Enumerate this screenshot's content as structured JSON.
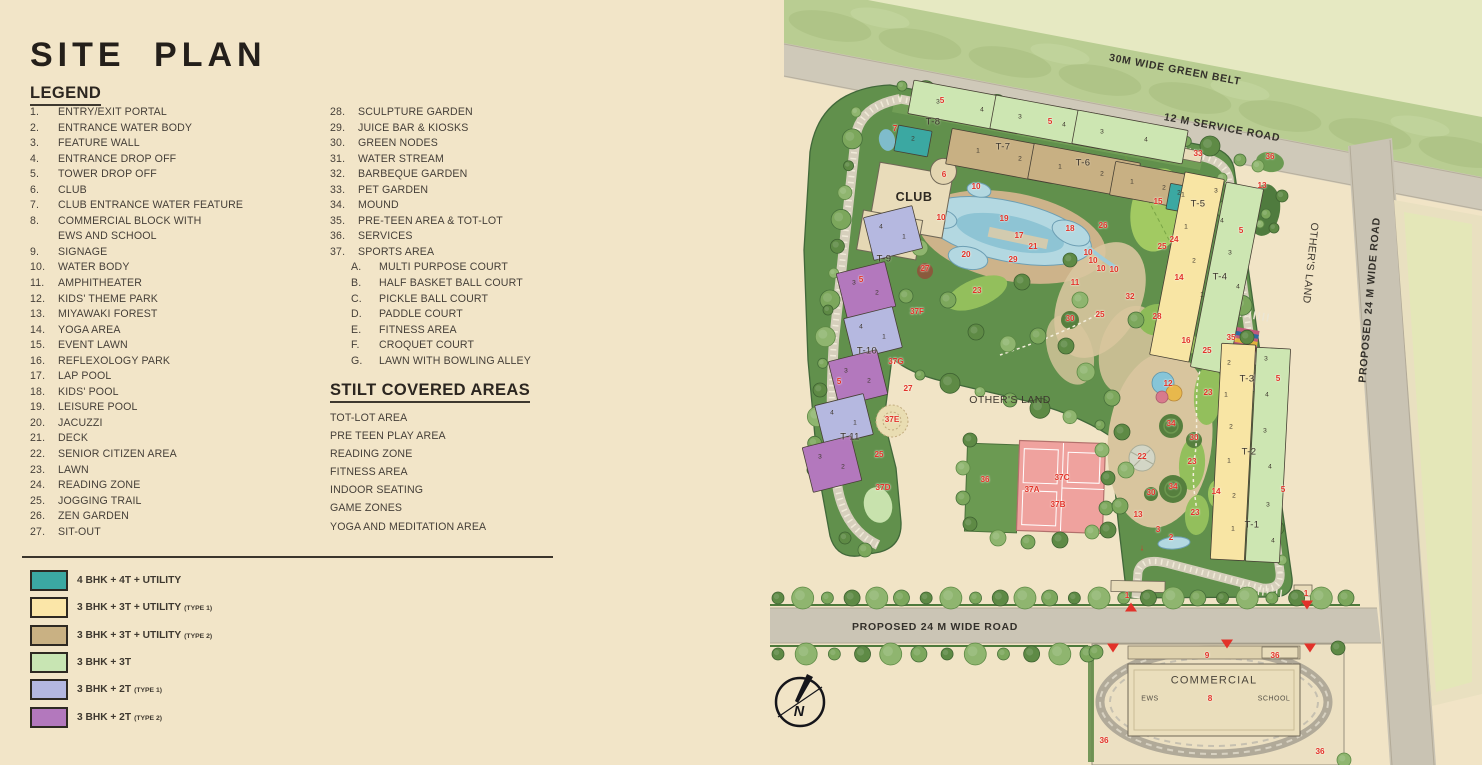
{
  "page": {
    "title": "SITE PLAN"
  },
  "legend": {
    "heading": "LEGEND",
    "col1": [
      {
        "n": "1.",
        "t": "ENTRY/EXIT PORTAL"
      },
      {
        "n": "2.",
        "t": "ENTRANCE WATER BODY"
      },
      {
        "n": "3.",
        "t": "FEATURE WALL"
      },
      {
        "n": "4.",
        "t": "ENTRANCE DROP OFF"
      },
      {
        "n": "5.",
        "t": "TOWER DROP OFF"
      },
      {
        "n": "6.",
        "t": "CLUB"
      },
      {
        "n": "7.",
        "t": "CLUB ENTRANCE WATER FEATURE"
      },
      {
        "n": "8.",
        "t": "COMMERCIAL BLOCK WITH"
      },
      {
        "n": "",
        "t": "EWS AND SCHOOL"
      },
      {
        "n": "9.",
        "t": "SIGNAGE"
      },
      {
        "n": "10.",
        "t": "WATER BODY"
      },
      {
        "n": "11.",
        "t": "AMPHITHEATER"
      },
      {
        "n": "12.",
        "t": "KIDS' THEME PARK"
      },
      {
        "n": "13.",
        "t": "MIYAWAKI FOREST"
      },
      {
        "n": "14.",
        "t": "YOGA AREA"
      },
      {
        "n": "15.",
        "t": "EVENT LAWN"
      },
      {
        "n": "16.",
        "t": "REFLEXOLOGY PARK"
      },
      {
        "n": "17.",
        "t": "LAP POOL"
      },
      {
        "n": "18.",
        "t": "KIDS' POOL"
      },
      {
        "n": "19.",
        "t": "LEISURE POOL"
      },
      {
        "n": "20.",
        "t": "JACUZZI"
      },
      {
        "n": "21.",
        "t": "DECK"
      },
      {
        "n": "22.",
        "t": "SENIOR CITIZEN AREA"
      },
      {
        "n": "23.",
        "t": "LAWN"
      },
      {
        "n": "24.",
        "t": "READING ZONE"
      },
      {
        "n": "25.",
        "t": "JOGGING TRAIL"
      },
      {
        "n": "26.",
        "t": "ZEN GARDEN"
      },
      {
        "n": "27.",
        "t": "SIT-OUT"
      }
    ],
    "col2": [
      {
        "n": "28.",
        "t": "SCULPTURE GARDEN"
      },
      {
        "n": "29.",
        "t": "JUICE BAR & KIOSKS"
      },
      {
        "n": "30.",
        "t": "GREEN NODES"
      },
      {
        "n": "31.",
        "t": "WATER STREAM"
      },
      {
        "n": "32.",
        "t": "BARBEQUE GARDEN"
      },
      {
        "n": "33.",
        "t": "PET GARDEN"
      },
      {
        "n": "34.",
        "t": "MOUND"
      },
      {
        "n": "35.",
        "t": "PRE-TEEN AREA & TOT-LOT"
      },
      {
        "n": "36.",
        "t": "SERVICES"
      },
      {
        "n": "37.",
        "t": "SPORTS AREA"
      }
    ],
    "col2_sub": [
      {
        "n": "A.",
        "t": "MULTI PURPOSE COURT"
      },
      {
        "n": "B.",
        "t": "HALF BASKET BALL COURT"
      },
      {
        "n": "C.",
        "t": "PICKLE BALL COURT"
      },
      {
        "n": "D.",
        "t": "PADDLE COURT"
      },
      {
        "n": "E.",
        "t": "FITNESS AREA"
      },
      {
        "n": "F.",
        "t": "CROQUET COURT"
      },
      {
        "n": "G.",
        "t": "LAWN WITH BOWLING ALLEY"
      }
    ]
  },
  "stilt": {
    "heading": "STILT COVERED AREAS",
    "items": [
      "TOT-LOT AREA",
      "PRE TEEN PLAY AREA",
      "READING ZONE",
      "FITNESS AREA",
      "INDOOR SEATING",
      "GAME ZONES",
      "YOGA AND MEDITATION AREA"
    ]
  },
  "unit_types": [
    {
      "color": "#3BA8A2",
      "label": "4 BHK + 4T + UTILITY",
      "sub": ""
    },
    {
      "color": "#FBE6A8",
      "label": "3 BHK + 3T + UTILITY",
      "sub": "(TYPE 1)"
    },
    {
      "color": "#C9B183",
      "label": "3 BHK + 3T + UTILITY",
      "sub": "(TYPE 2)"
    },
    {
      "color": "#C8E5B3",
      "label": "3 BHK + 3T",
      "sub": ""
    },
    {
      "color": "#B4B7E0",
      "label": "3 BHK + 2T",
      "sub": "(TYPE 1)"
    },
    {
      "color": "#B378BD",
      "label": "3 BHK + 2T",
      "sub": "(TYPE 2)"
    }
  ],
  "map": {
    "colors": {
      "teal": "#3BA8A2",
      "yellow": "#F8E5A4",
      "tan": "#C8B083",
      "green": "#CDE6B2",
      "lilac": "#B5B8E0",
      "purple": "#B378BD",
      "red": "#E2322A"
    },
    "labels": [
      {
        "t": "30M WIDE GREEN BELT",
        "x": 405,
        "y": 70,
        "k": "road",
        "r": 10.5
      },
      {
        "t": "12 M SERVICE ROAD",
        "x": 452,
        "y": 128,
        "k": "road",
        "r": 10.5
      },
      {
        "t": "PROPOSED 24 M WIDE ROAD",
        "x": 600,
        "y": 300,
        "k": "road",
        "r": -85
      },
      {
        "t": "PROPOSED 24 M WIDE ROAD",
        "x": 165,
        "y": 627,
        "k": "road"
      },
      {
        "t": "OTHER'S LAND",
        "x": 540,
        "y": 263,
        "k": "place",
        "r": 96
      },
      {
        "t": "OTHER'S LAND",
        "x": 240,
        "y": 400,
        "k": "place"
      },
      {
        "t": "CLUB",
        "x": 144,
        "y": 197,
        "k": "big"
      },
      {
        "t": "COMMERCIAL",
        "x": 444,
        "y": 681,
        "k": "big2"
      },
      {
        "t": "EWS",
        "x": 380,
        "y": 699,
        "k": "small"
      },
      {
        "t": "SCHOOL",
        "x": 504,
        "y": 699,
        "k": "small"
      },
      {
        "t": "N",
        "x": 29,
        "y": 712,
        "k": "compass"
      },
      {
        "t": "T-8",
        "x": 163,
        "y": 122,
        "k": "tower"
      },
      {
        "t": "T-7",
        "x": 233,
        "y": 147,
        "k": "tower"
      },
      {
        "t": "T-6",
        "x": 313,
        "y": 163,
        "k": "tower"
      },
      {
        "t": "T-9",
        "x": 114,
        "y": 259,
        "k": "tower"
      },
      {
        "t": "T-10",
        "x": 97,
        "y": 351,
        "k": "tower"
      },
      {
        "t": "T-11",
        "x": 80,
        "y": 437,
        "k": "tower"
      },
      {
        "t": "T-5",
        "x": 428,
        "y": 204,
        "k": "tower"
      },
      {
        "t": "T-4",
        "x": 450,
        "y": 277,
        "k": "tower"
      },
      {
        "t": "T-3",
        "x": 477,
        "y": 379,
        "k": "tower"
      },
      {
        "t": "T-2",
        "x": 479,
        "y": 452,
        "k": "tower"
      },
      {
        "t": "T-1",
        "x": 482,
        "y": 525,
        "k": "tower"
      },
      {
        "t": "5",
        "x": 172,
        "y": 101,
        "k": "red"
      },
      {
        "t": "7",
        "x": 125,
        "y": 129,
        "k": "red"
      },
      {
        "t": "5",
        "x": 280,
        "y": 122,
        "k": "red"
      },
      {
        "t": "6",
        "x": 174,
        "y": 175,
        "k": "red"
      },
      {
        "t": "10",
        "x": 206,
        "y": 187,
        "k": "red"
      },
      {
        "t": "10",
        "x": 171,
        "y": 218,
        "k": "red"
      },
      {
        "t": "19",
        "x": 234,
        "y": 219,
        "k": "red"
      },
      {
        "t": "18",
        "x": 300,
        "y": 229,
        "k": "red"
      },
      {
        "t": "26",
        "x": 333,
        "y": 226,
        "k": "red"
      },
      {
        "t": "17",
        "x": 249,
        "y": 236,
        "k": "red"
      },
      {
        "t": "21",
        "x": 263,
        "y": 247,
        "k": "red"
      },
      {
        "t": "20",
        "x": 196,
        "y": 255,
        "k": "red"
      },
      {
        "t": "29",
        "x": 243,
        "y": 260,
        "k": "red"
      },
      {
        "t": "27",
        "x": 155,
        "y": 269,
        "k": "red"
      },
      {
        "t": "23",
        "x": 207,
        "y": 291,
        "k": "red"
      },
      {
        "t": "11",
        "x": 305,
        "y": 283,
        "k": "red"
      },
      {
        "t": "10",
        "x": 318,
        "y": 253,
        "k": "red"
      },
      {
        "t": "10",
        "x": 323,
        "y": 261,
        "k": "red"
      },
      {
        "t": "10",
        "x": 331,
        "y": 269,
        "k": "red"
      },
      {
        "t": "10",
        "x": 344,
        "y": 270,
        "k": "red"
      },
      {
        "t": "37F",
        "x": 147,
        "y": 312,
        "k": "red"
      },
      {
        "t": "30",
        "x": 300,
        "y": 319,
        "k": "red"
      },
      {
        "t": "25",
        "x": 330,
        "y": 315,
        "k": "red"
      },
      {
        "t": "5",
        "x": 91,
        "y": 280,
        "k": "red"
      },
      {
        "t": "33",
        "x": 428,
        "y": 154,
        "k": "red"
      },
      {
        "t": "36",
        "x": 500,
        "y": 157,
        "k": "red"
      },
      {
        "t": "13",
        "x": 492,
        "y": 186,
        "k": "red"
      },
      {
        "t": "15",
        "x": 388,
        "y": 202,
        "k": "red"
      },
      {
        "t": "24",
        "x": 404,
        "y": 240,
        "k": "red"
      },
      {
        "t": "25",
        "x": 392,
        "y": 247,
        "k": "red"
      },
      {
        "t": "5",
        "x": 471,
        "y": 231,
        "k": "red"
      },
      {
        "t": "14",
        "x": 409,
        "y": 278,
        "k": "red"
      },
      {
        "t": "32",
        "x": 360,
        "y": 297,
        "k": "red"
      },
      {
        "t": "28",
        "x": 387,
        "y": 317,
        "k": "red"
      },
      {
        "t": "16",
        "x": 416,
        "y": 341,
        "k": "red"
      },
      {
        "t": "25",
        "x": 437,
        "y": 351,
        "k": "red"
      },
      {
        "t": "35",
        "x": 461,
        "y": 338,
        "k": "red"
      },
      {
        "t": "12",
        "x": 398,
        "y": 384,
        "k": "red"
      },
      {
        "t": "23",
        "x": 438,
        "y": 393,
        "k": "red"
      },
      {
        "t": "34",
        "x": 401,
        "y": 424,
        "k": "red"
      },
      {
        "t": "30",
        "x": 424,
        "y": 438,
        "k": "red"
      },
      {
        "t": "22",
        "x": 372,
        "y": 457,
        "k": "red"
      },
      {
        "t": "23",
        "x": 422,
        "y": 462,
        "k": "red"
      },
      {
        "t": "34",
        "x": 403,
        "y": 487,
        "k": "red"
      },
      {
        "t": "30",
        "x": 381,
        "y": 493,
        "k": "red"
      },
      {
        "t": "14",
        "x": 446,
        "y": 492,
        "k": "red"
      },
      {
        "t": "23",
        "x": 425,
        "y": 513,
        "k": "red"
      },
      {
        "t": "13",
        "x": 368,
        "y": 515,
        "k": "red"
      },
      {
        "t": "3",
        "x": 388,
        "y": 530,
        "k": "red"
      },
      {
        "t": "2",
        "x": 401,
        "y": 538,
        "k": "red"
      },
      {
        "t": "↓",
        "x": 372,
        "y": 548,
        "k": "arrow"
      },
      {
        "t": "5",
        "x": 508,
        "y": 379,
        "k": "red"
      },
      {
        "t": "5",
        "x": 513,
        "y": 490,
        "k": "red"
      },
      {
        "t": "37G",
        "x": 126,
        "y": 362,
        "k": "red"
      },
      {
        "t": "27",
        "x": 138,
        "y": 389,
        "k": "red"
      },
      {
        "t": "37E",
        "x": 122,
        "y": 420,
        "k": "red"
      },
      {
        "t": "25",
        "x": 109,
        "y": 455,
        "k": "red"
      },
      {
        "t": "37D",
        "x": 113,
        "y": 488,
        "k": "red"
      },
      {
        "t": "5",
        "x": 69,
        "y": 382,
        "k": "red"
      },
      {
        "t": "36",
        "x": 215,
        "y": 480,
        "k": "red"
      },
      {
        "t": "37A",
        "x": 262,
        "y": 490,
        "k": "red"
      },
      {
        "t": "37B",
        "x": 288,
        "y": 505,
        "k": "red"
      },
      {
        "t": "37C",
        "x": 292,
        "y": 478,
        "k": "red"
      },
      {
        "t": "1",
        "x": 357,
        "y": 596,
        "k": "red"
      },
      {
        "t": "1",
        "x": 536,
        "y": 594,
        "k": "red"
      },
      {
        "t": "9",
        "x": 437,
        "y": 656,
        "k": "red"
      },
      {
        "t": "36",
        "x": 505,
        "y": 656,
        "k": "red"
      },
      {
        "t": "8",
        "x": 440,
        "y": 699,
        "k": "red"
      },
      {
        "t": "36",
        "x": 334,
        "y": 741,
        "k": "red"
      },
      {
        "t": "36",
        "x": 550,
        "y": 752,
        "k": "red"
      },
      {
        "t": "2",
        "x": 143,
        "y": 140,
        "k": "unit"
      },
      {
        "t": "3",
        "x": 168,
        "y": 103,
        "k": "unit"
      },
      {
        "t": "4",
        "x": 212,
        "y": 111,
        "k": "unit"
      },
      {
        "t": "3",
        "x": 250,
        "y": 118,
        "k": "unit"
      },
      {
        "t": "4",
        "x": 294,
        "y": 126,
        "k": "unit"
      },
      {
        "t": "3",
        "x": 332,
        "y": 133,
        "k": "unit"
      },
      {
        "t": "4",
        "x": 376,
        "y": 141,
        "k": "unit"
      },
      {
        "t": "1",
        "x": 208,
        "y": 152,
        "k": "unit"
      },
      {
        "t": "2",
        "x": 250,
        "y": 160,
        "k": "unit"
      },
      {
        "t": "1",
        "x": 290,
        "y": 168,
        "k": "unit"
      },
      {
        "t": "2",
        "x": 332,
        "y": 175,
        "k": "unit"
      },
      {
        "t": "1",
        "x": 362,
        "y": 183,
        "k": "unit"
      },
      {
        "t": "2",
        "x": 394,
        "y": 189,
        "k": "unit"
      },
      {
        "t": "1",
        "x": 413,
        "y": 196,
        "k": "unit"
      },
      {
        "t": "4",
        "x": 111,
        "y": 228,
        "k": "unit"
      },
      {
        "t": "1",
        "x": 134,
        "y": 238,
        "k": "unit"
      },
      {
        "t": "3",
        "x": 84,
        "y": 284,
        "k": "unit"
      },
      {
        "t": "2",
        "x": 107,
        "y": 294,
        "k": "unit"
      },
      {
        "t": "4",
        "x": 91,
        "y": 328,
        "k": "unit"
      },
      {
        "t": "1",
        "x": 114,
        "y": 338,
        "k": "unit"
      },
      {
        "t": "3",
        "x": 76,
        "y": 372,
        "k": "unit"
      },
      {
        "t": "2",
        "x": 99,
        "y": 382,
        "k": "unit"
      },
      {
        "t": "4",
        "x": 62,
        "y": 414,
        "k": "unit"
      },
      {
        "t": "1",
        "x": 85,
        "y": 424,
        "k": "unit"
      },
      {
        "t": "3",
        "x": 50,
        "y": 458,
        "k": "unit"
      },
      {
        "t": "2",
        "x": 73,
        "y": 468,
        "k": "unit"
      },
      {
        "t": "2",
        "x": 409,
        "y": 194,
        "k": "unit"
      },
      {
        "t": "1",
        "x": 416,
        "y": 228,
        "k": "unit"
      },
      {
        "t": "2",
        "x": 424,
        "y": 262,
        "k": "unit"
      },
      {
        "t": "1",
        "x": 432,
        "y": 296,
        "k": "unit"
      },
      {
        "t": "3",
        "x": 446,
        "y": 192,
        "k": "unit"
      },
      {
        "t": "4",
        "x": 452,
        "y": 222,
        "k": "unit"
      },
      {
        "t": "3",
        "x": 460,
        "y": 254,
        "k": "unit"
      },
      {
        "t": "4",
        "x": 468,
        "y": 288,
        "k": "unit"
      },
      {
        "t": "2",
        "x": 459,
        "y": 364,
        "k": "unit"
      },
      {
        "t": "1",
        "x": 456,
        "y": 396,
        "k": "unit"
      },
      {
        "t": "2",
        "x": 461,
        "y": 428,
        "k": "unit"
      },
      {
        "t": "1",
        "x": 459,
        "y": 462,
        "k": "unit"
      },
      {
        "t": "2",
        "x": 464,
        "y": 497,
        "k": "unit"
      },
      {
        "t": "1",
        "x": 463,
        "y": 530,
        "k": "unit"
      },
      {
        "t": "3",
        "x": 496,
        "y": 360,
        "k": "unit"
      },
      {
        "t": "4",
        "x": 497,
        "y": 396,
        "k": "unit"
      },
      {
        "t": "3",
        "x": 495,
        "y": 432,
        "k": "unit"
      },
      {
        "t": "4",
        "x": 500,
        "y": 468,
        "k": "unit"
      },
      {
        "t": "3",
        "x": 498,
        "y": 506,
        "k": "unit"
      },
      {
        "t": "4",
        "x": 503,
        "y": 542,
        "k": "unit"
      }
    ],
    "triangles": [
      {
        "d": "up",
        "x": 361,
        "y": 607
      },
      {
        "d": "down",
        "x": 537,
        "y": 605
      },
      {
        "d": "down",
        "x": 343,
        "y": 648
      },
      {
        "d": "down",
        "x": 457,
        "y": 644
      },
      {
        "d": "down",
        "x": 540,
        "y": 648
      }
    ]
  }
}
